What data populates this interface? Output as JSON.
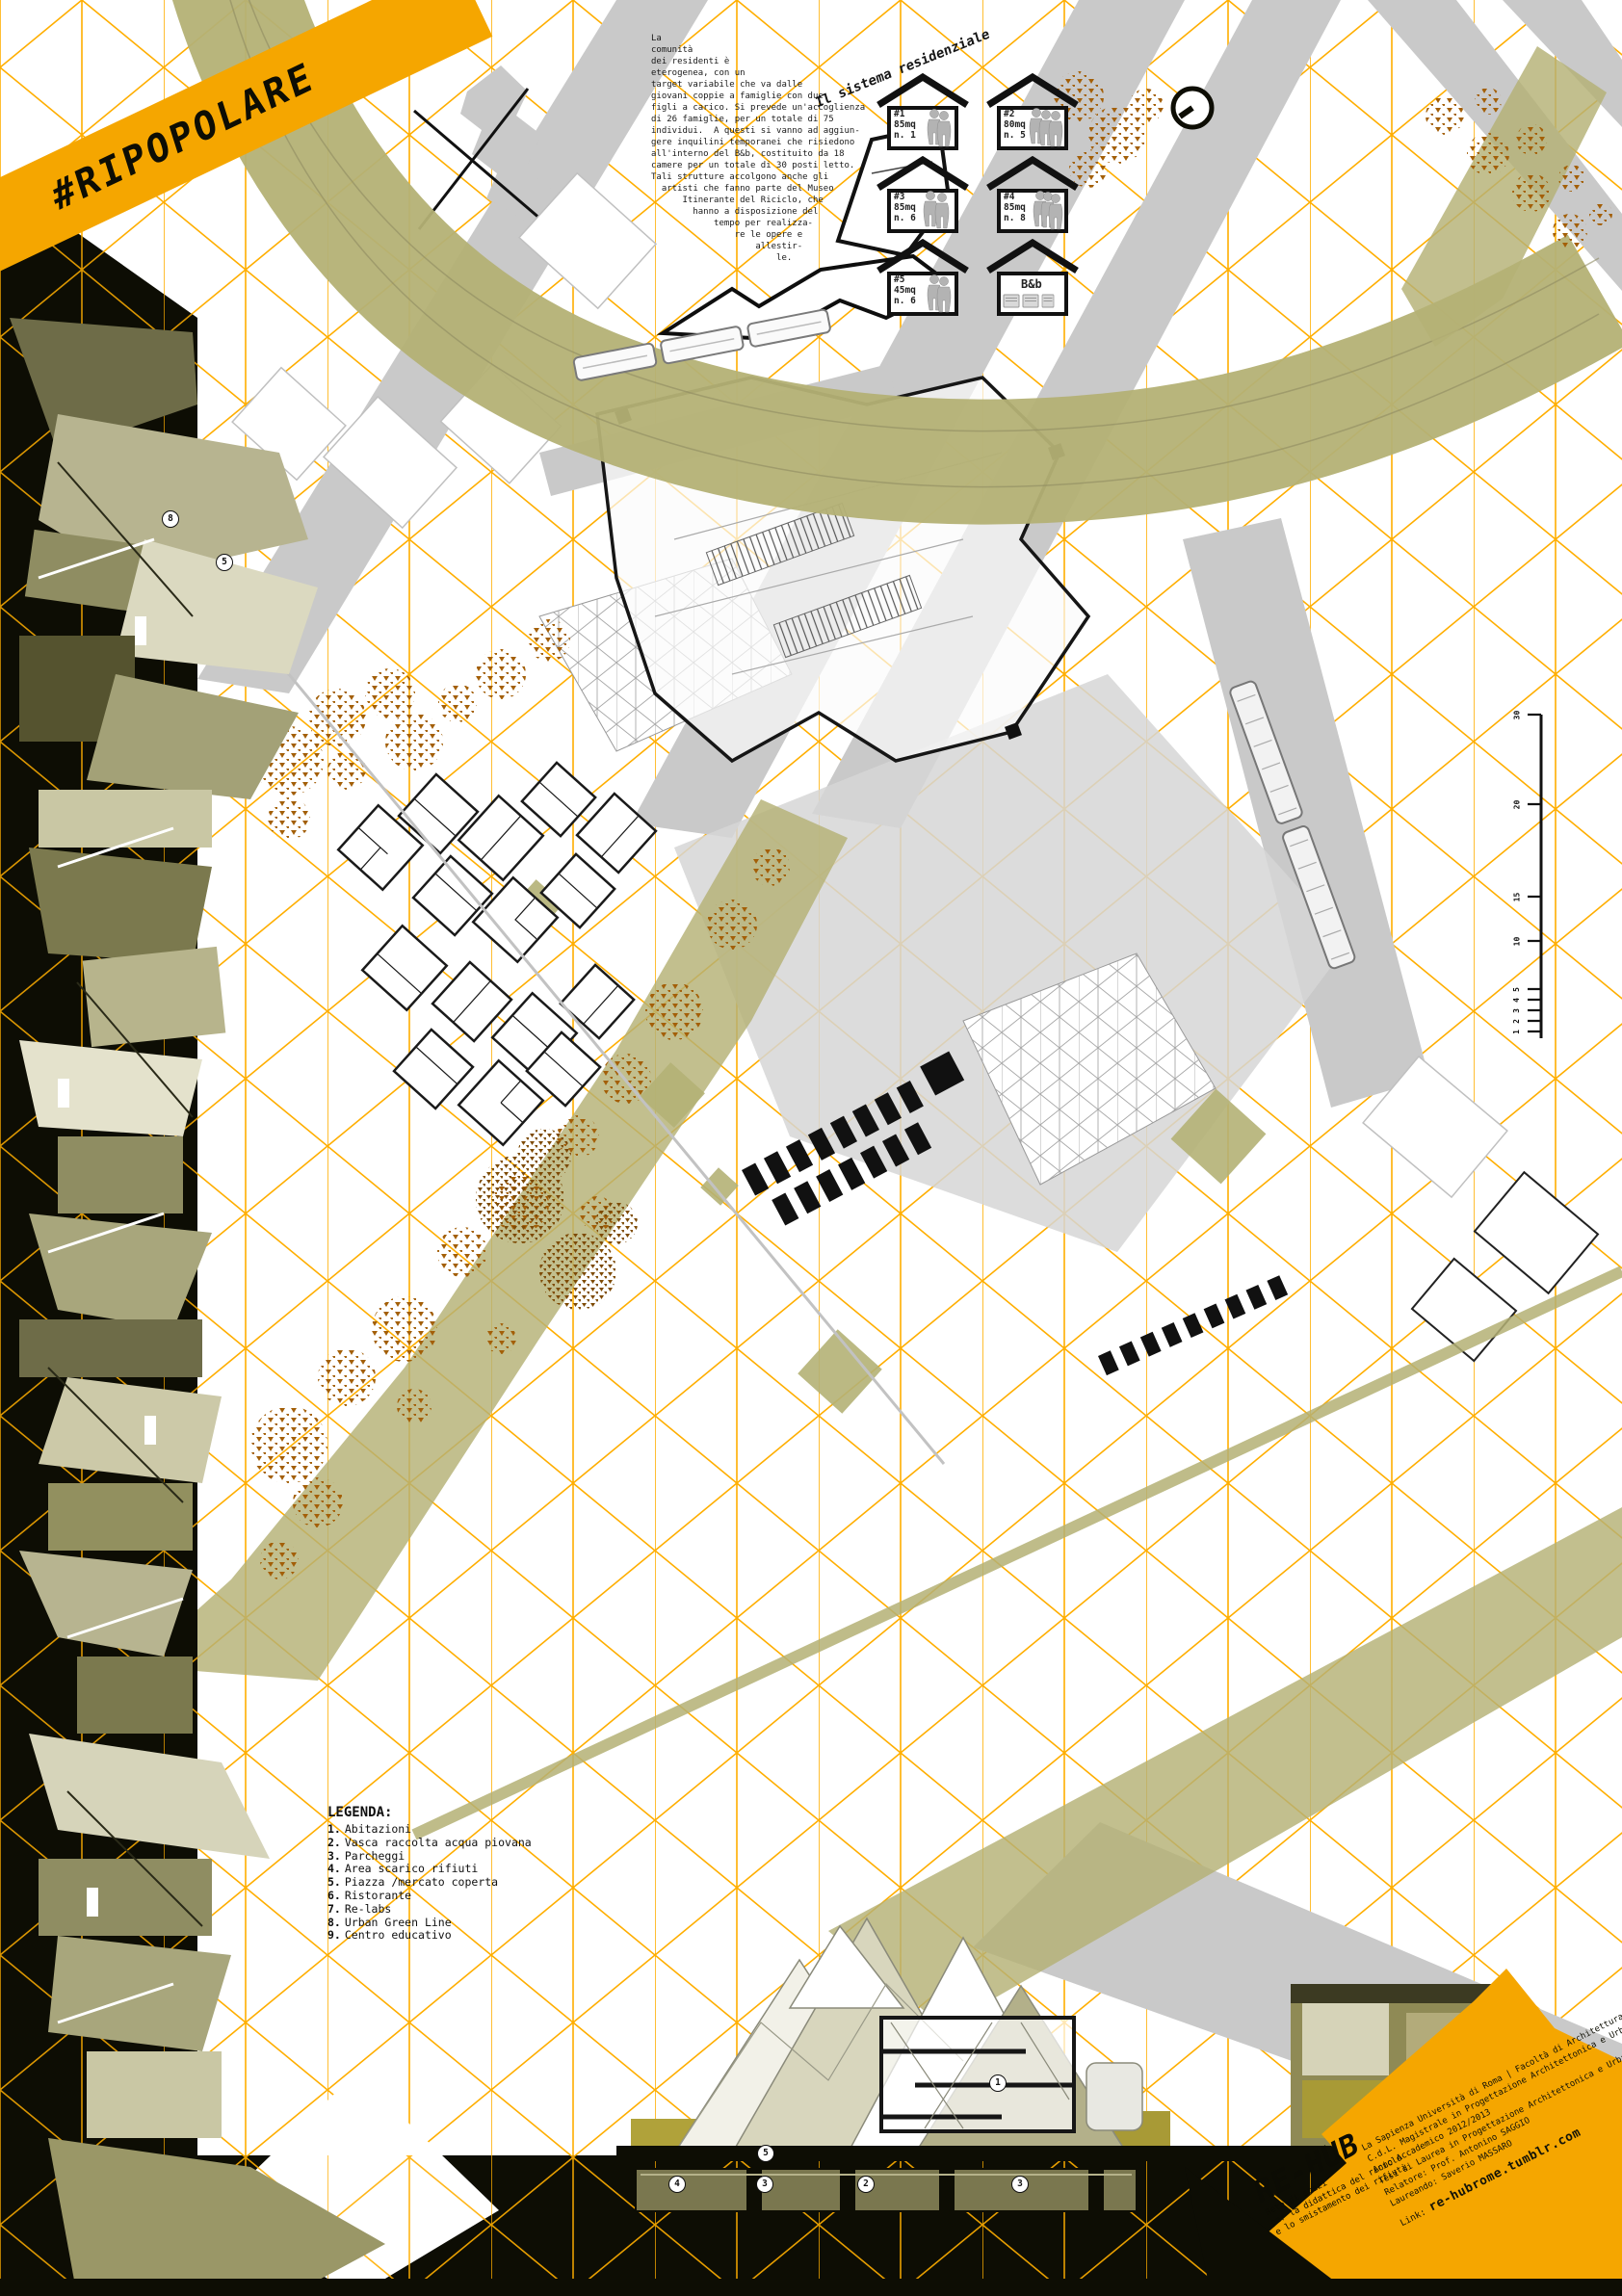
{
  "poster": {
    "hashtag": "#RIPOPOLARE",
    "intro_text": "La\ncomunità\ndei residenti è\neterogenea, con un\ntarget variabile che va dalle\ngiovani coppie a famiglie con due\nfigli a carico. Si prevede un'accoglienza\ndi 26 famiglie, per un totale di 75\nindividui.  A questi si vanno ad aggiun-\ngere inquilini temporanei che risiedono\nall'interno del B&b, costituito da 18\ncamere per un totale di 30 posti letto.\nTali strutture accolgono anche gli\n  artisti che fanno parte del Museo\n      Itinerante del Riciclo, che\n        hanno a disposizione del\n            tempo per realizza-\n                re le opere e\n                    allestir-\n                        le.",
    "residential": {
      "title": "Il sistema residenziale",
      "houses": [
        {
          "id": "#1",
          "area": "85mq",
          "units": "n. 1"
        },
        {
          "id": "#2",
          "area": "80mq",
          "units": "n. 5"
        },
        {
          "id": "#3",
          "area": "85mq",
          "units": "n. 6"
        },
        {
          "id": "#4",
          "area": "85mq",
          "units": "n. 8"
        },
        {
          "id": "#5",
          "area": "45mq",
          "units": "n. 6"
        },
        {
          "id": "B&b",
          "area": "",
          "units": ""
        }
      ]
    },
    "legend": {
      "title": "LEGENDA:",
      "items": [
        {
          "num": "1.",
          "label": "Abitazioni"
        },
        {
          "num": "2.",
          "label": "Vasca raccolta acqua piovana"
        },
        {
          "num": "3.",
          "label": "Parcheggi"
        },
        {
          "num": "4.",
          "label": "Area scarico rifiuti"
        },
        {
          "num": "5.",
          "label": "Piazza /mercato coperta"
        },
        {
          "num": "6.",
          "label": "Ristorante"
        },
        {
          "num": "7.",
          "label": "Re-labs"
        },
        {
          "num": "8.",
          "label": "Urban Green Line"
        },
        {
          "num": "9.",
          "label": "Centro educativo"
        }
      ]
    },
    "scalebar": [
      "30",
      "20",
      "15",
      "10",
      "5",
      "4",
      "3",
      "2",
      "1"
    ],
    "markers": {
      "section": [
        "1",
        "5"
      ],
      "base": [
        "4",
        "3",
        "2",
        "3"
      ],
      "strip": [
        "8",
        "5"
      ]
    },
    "logo": {
      "name": "RE-HUB",
      "tagline": [
        "Rete di spazi",
        "per la didattica del riciclo",
        "e lo smistamento dei rifiuti"
      ]
    },
    "credits": {
      "lines": [
        "La Sapienza Università di Roma | Facoltà di Architettura",
        "C.d.L. Magistrale in Progettazione Architettonica e Urbana",
        "Anno Accademico 2012/2013",
        "Tesi di Laurea in Progettazione Architettonica e Urbana",
        "Relatore: Prof. Antonino SAGGIO",
        "Laureando: Saverio MASSARO"
      ],
      "link_label": "Link:",
      "link_url": "re-hubrome.tumblr.com"
    },
    "colors": {
      "accent_yellow": "#F5A600",
      "grid_orange": "#FFAE00",
      "olive": "#b4b175",
      "road_gray": "#c9c9c9",
      "tree_brown": "#a35f08",
      "black": "#0d0d04"
    }
  }
}
